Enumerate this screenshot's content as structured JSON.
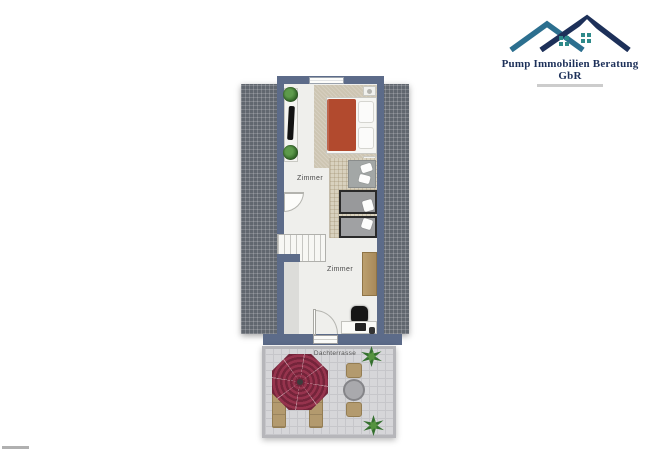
{
  "logo": {
    "company_name": "Pump Immobilien Beratung GbR",
    "colors": {
      "roof_dark": "#1d3059",
      "roof_light": "#2c6f8f",
      "window_teal": "#2e8a8a"
    }
  },
  "plan": {
    "labels": {
      "room_upper": "Zimmer",
      "room_lower": "Zimmer",
      "terrace": "Dachterrasse"
    },
    "colors": {
      "wall": "#5c6b89",
      "roof_tiles": "#61676f",
      "umbrella": "#8e3048",
      "bed_duvet": "#b24a2e",
      "wood_furniture": "#b39a6e",
      "terrace_floor": "#d6d6d9"
    }
  }
}
